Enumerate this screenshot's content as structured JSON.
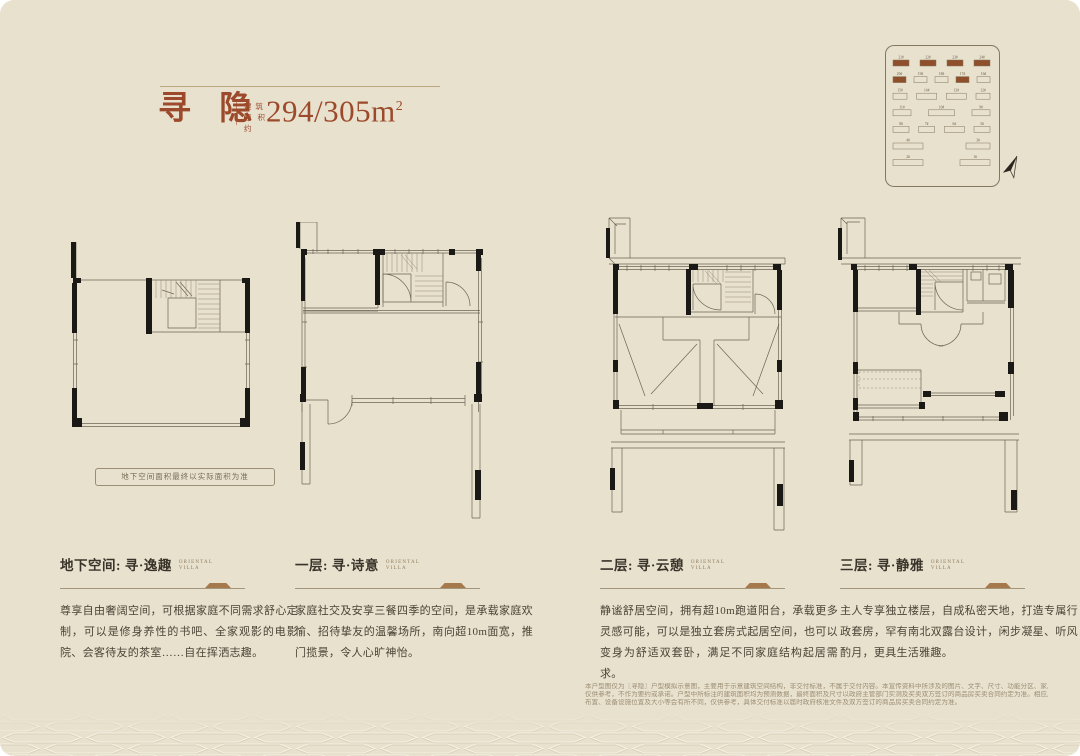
{
  "header": {
    "title": "寻 隐",
    "area_label_line1": "建 筑",
    "area_label_line2": "面积约",
    "area_value": "294/305m",
    "area_sup": "2"
  },
  "site_plan": {
    "highlight_color": "#8f4f2b",
    "line_color": "#84775e",
    "rows": [
      {
        "blocks": [
          {
            "l": "21#",
            "h": true,
            "w": 16
          },
          {
            "l": "22#",
            "h": true,
            "w": 16
          },
          {
            "l": "23#",
            "h": true,
            "w": 16
          },
          {
            "l": "24#",
            "h": true,
            "w": 16
          }
        ]
      },
      {
        "blocks": [
          {
            "l": "20#",
            "h": true,
            "w": 13
          },
          {
            "l": "19#",
            "h": false,
            "w": 13
          },
          {
            "l": "18#",
            "h": false,
            "w": 13
          },
          {
            "l": "17#",
            "h": true,
            "w": 13
          },
          {
            "l": "16#",
            "h": false,
            "w": 13
          }
        ]
      },
      {
        "blocks": [
          {
            "l": "15#",
            "h": false,
            "w": 14
          },
          {
            "l": "14#",
            "h": false,
            "w": 20
          },
          {
            "l": "13#",
            "h": false,
            "w": 20
          },
          {
            "l": "12#",
            "h": false,
            "w": 14
          }
        ]
      },
      {
        "blocks": [
          {
            "l": "11#",
            "h": false,
            "w": 18
          },
          {
            "l": "10#",
            "h": false,
            "w": 26
          },
          {
            "l": "9#",
            "h": false,
            "w": 18
          }
        ]
      },
      {
        "blocks": [
          {
            "l": "8#",
            "h": false,
            "w": 16
          },
          {
            "l": "7#",
            "h": false,
            "w": 16
          },
          {
            "l": "6#",
            "h": false,
            "w": 20
          },
          {
            "l": "5#",
            "h": false,
            "w": 16
          }
        ]
      },
      {
        "blocks": [
          {
            "l": "4#",
            "h": false,
            "w": 30
          },
          {
            "l": "3#",
            "h": false,
            "w": 24
          }
        ]
      },
      {
        "blocks": [
          {
            "l": "2#",
            "h": false,
            "w": 30
          },
          {
            "l": "1#",
            "h": false,
            "w": 30
          }
        ]
      }
    ]
  },
  "floor_plans": {
    "basement_note": "地下空间面积最终以实际面积为准"
  },
  "sections": [
    {
      "title": "地下空间: 寻·逸趣",
      "subtitle_line1": "ORIENTAL",
      "subtitle_line2": "VILLA",
      "body": "尊享自由奢阔空间，可根据家庭不同需求舒心定制，可以是修身养性的书吧、全家观影的电影院、会客待友的茶室……自在挥洒志趣。"
    },
    {
      "title": "一层: 寻·诗意",
      "subtitle_line1": "ORIENTAL",
      "subtitle_line2": "VILLA",
      "body": "家庭社交及安享三餐四季的空间，是承载家庭欢愉、招待挚友的温馨场所，南向超10m面宽，推门揽景，令人心旷神怡。"
    },
    {
      "title": "二层: 寻·云憩",
      "subtitle_line1": "ORIENTAL",
      "subtitle_line2": "VILLA",
      "body": "静谧舒居空间，拥有超10m跑道阳台，承载更多灵感可能，可以是独立套房式起居空间，也可以变身为舒适双套卧，满足不同家庭结构起居需求。"
    },
    {
      "title": "三层: 寻·静雅",
      "subtitle_line1": "ORIENTAL",
      "subtitle_line2": "VILLA",
      "body": "主人专享独立楼层，自成私密天地，打造专属行政套房，罕有南北双露台设计，闲步凝星、听风酌月，更具生活雅趣。"
    }
  ],
  "disclaimer": {
    "lines": [
      "本户型图仅为〖寻隐〗户型模拟示意图，主要用于示意建筑空间结构，非交付标准，不属于交付内容。本宣传资料中所涉及的图片、文字、尺寸、功能分区、家具、绿植摆设、装修陈设等仅作为示意参考，",
      "仅供参考，不作为要约或承诺。户型中所标注的建筑面积均为预测数据，最终面积及尺寸以政府主管部门实测及买卖双方签订的商品房买卖合同约定为准。相应户型结构、墙体、门窗、层高、面积、管线",
      "布置、设备设施位置及大小等会有所不同，仅供参考，具体交付标准以届时政府核准文件及双方签订的商品房买卖合同约定为准。"
    ]
  },
  "colors": {
    "background": "#e8e1ce",
    "accent_red": "#9c4a2b",
    "accent_gold": "#a5794c",
    "text_dark": "#3a332a"
  }
}
